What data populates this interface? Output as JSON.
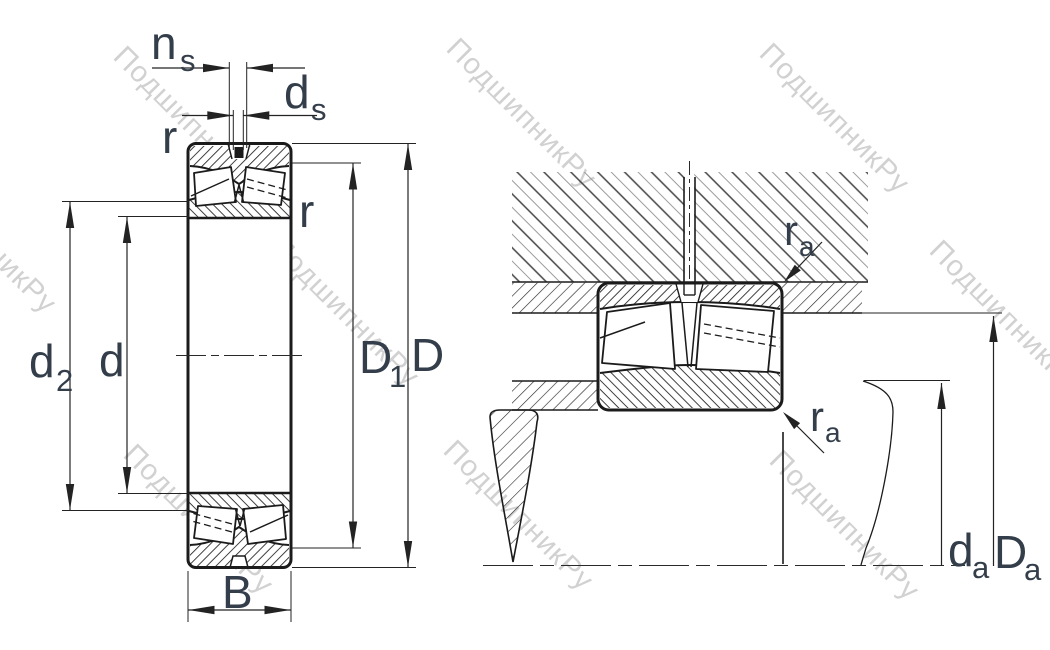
{
  "title": "spherical-roller-bearing-dimension-drawing",
  "watermark": {
    "text": "ПодшипникРу"
  },
  "labels": {
    "ns": {
      "base": "n",
      "sub": "s"
    },
    "ds": {
      "base": "d",
      "sub": "s"
    },
    "r_outer": {
      "base": "r"
    },
    "r_inner": {
      "base": "r"
    },
    "d2": {
      "base": "d",
      "sub": "2"
    },
    "d": {
      "base": "d"
    },
    "D1": {
      "base": "D",
      "sub": "1"
    },
    "D": {
      "base": "D"
    },
    "B": {
      "base": "B"
    },
    "ra_housing": {
      "base": "r",
      "sub": "a"
    },
    "ra_shaft": {
      "base": "r",
      "sub": "a"
    },
    "da": {
      "base": "d",
      "sub": "a"
    },
    "Da": {
      "base": "D",
      "sub": "a"
    }
  },
  "colors": {
    "line": "#1b1b1b",
    "dimension_line": "#232323",
    "label": "#333e4a",
    "watermark": "#c6c6c6",
    "hatch_fine": "#1f1f1f",
    "hatch_coarse_dark": "#454545",
    "hatch_coarse_light": "#9c9c9c",
    "background": "#ffffff"
  }
}
